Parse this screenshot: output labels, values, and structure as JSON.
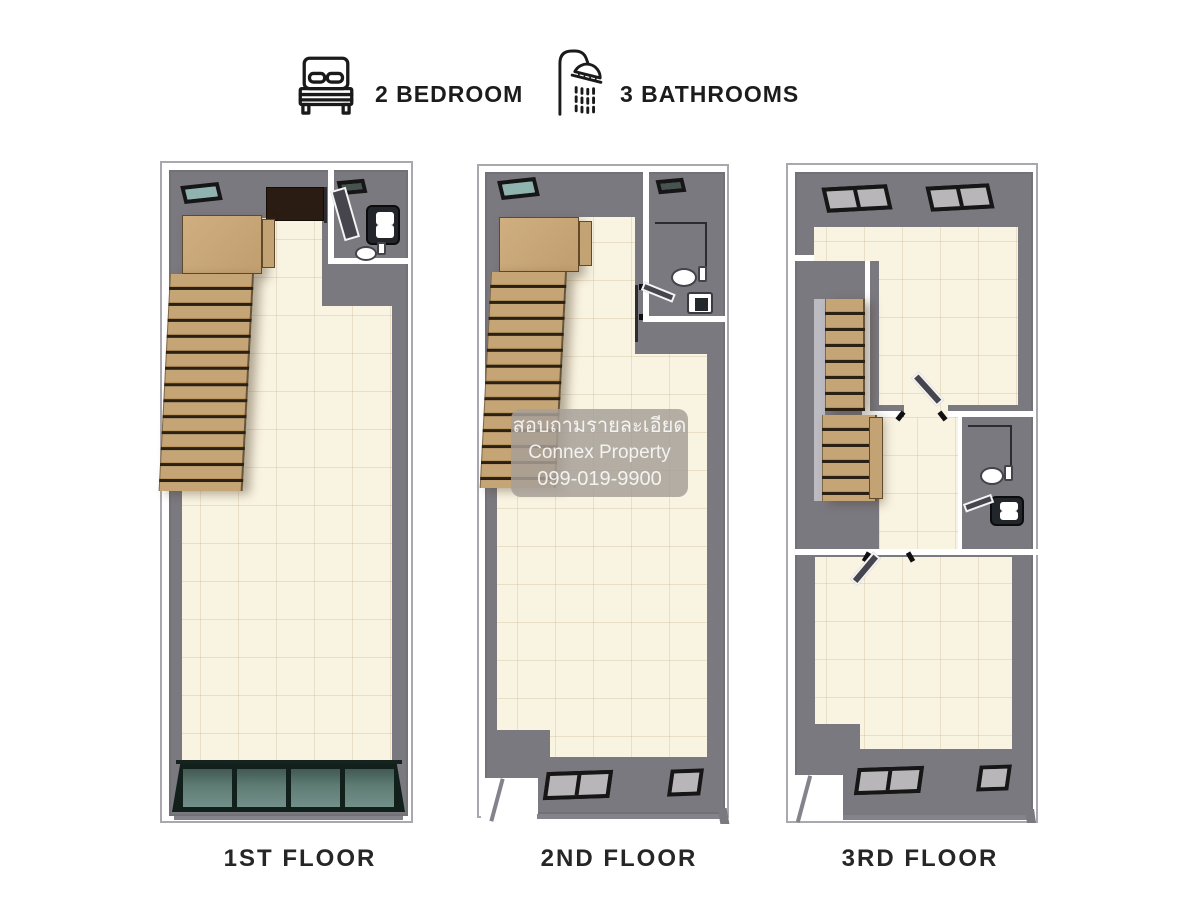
{
  "summary": {
    "bedrooms_label": "2 BEDROOM",
    "bathrooms_label": "3 BATHROOMS"
  },
  "icons": {
    "bedrooms": "bed-icon",
    "bathrooms": "shower-icon"
  },
  "floors": [
    {
      "label": "1ST FLOOR"
    },
    {
      "label": "2ND FLOOR"
    },
    {
      "label": "3RD FLOOR"
    }
  ],
  "watermark": {
    "line1": "สอบถามรายละเอียด",
    "line2": "Connex Property",
    "line3": "099-019-9900"
  },
  "colors": {
    "wall": "#7b7980",
    "floor_cream": "#f9f3e1",
    "stair_wood": "#c5a476",
    "stair_wood_dark": "#b8935e",
    "stair_line": "#2a2014",
    "frame_black": "#161616",
    "glass_teal": "#8fb3ae",
    "glass_dark_teal": "#5a776f",
    "glass_grey": "#b9b6ba",
    "label_text": "#262626"
  }
}
